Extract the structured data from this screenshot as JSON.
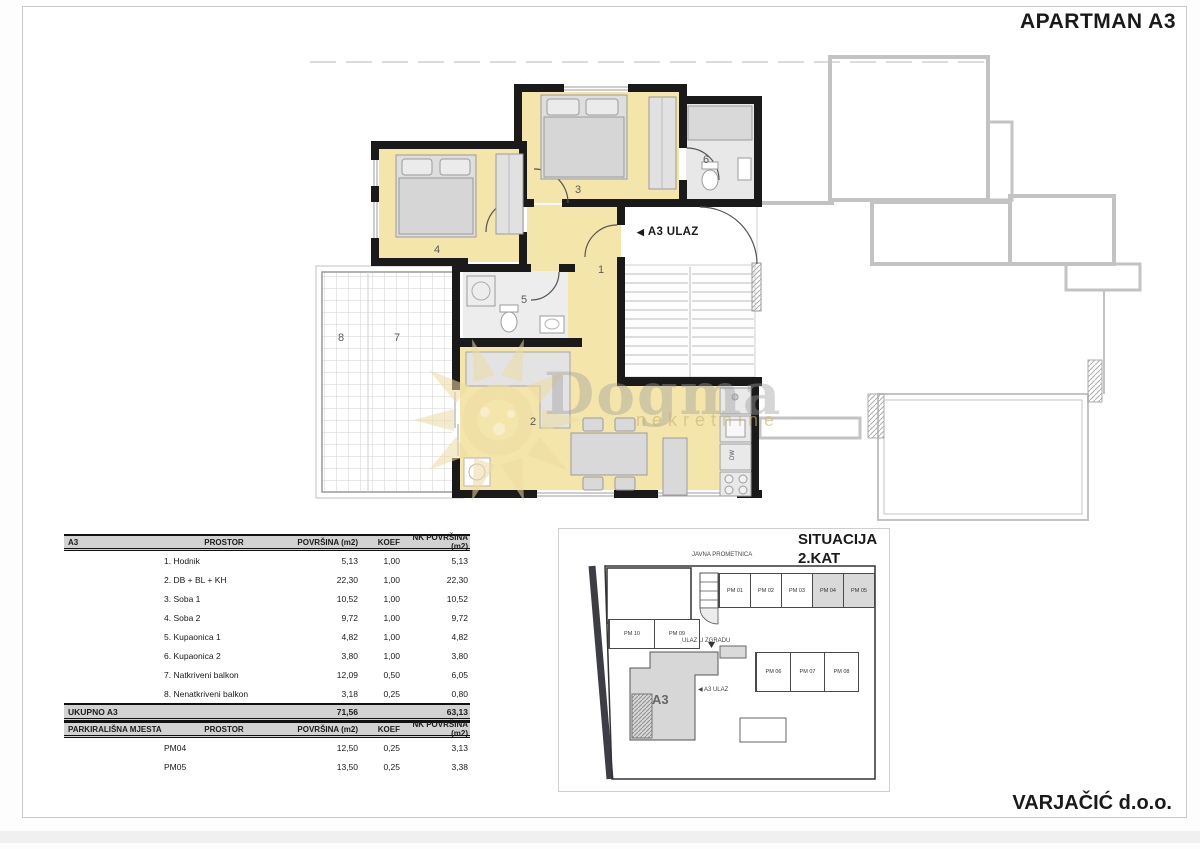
{
  "page": {
    "title": "APARTMAN A3",
    "company": "VARJAČIĆ d.o.o."
  },
  "floorplan": {
    "entrance_arrow": "◀",
    "entrance_label": "A3 ULAZ",
    "dishwasher_label": "DW",
    "room_numbers": {
      "hall": "1",
      "living": "2",
      "bedroom1": "3",
      "bedroom2": "4",
      "bathroom1": "5",
      "bathroom2": "6",
      "covered_balcony": "7",
      "uncovered_balcony": "8"
    },
    "watermark": {
      "brand": "Dogma",
      "subtitle": "nekretnine"
    }
  },
  "area_table": {
    "headers": {
      "group": "A3",
      "space": "PROSTOR",
      "area": "POVRŠINA (m2)",
      "koef": "KOEF",
      "nk_area": "NK POVRŠINA (m2)"
    },
    "rows": [
      {
        "name": "1. Hodnik",
        "area": "5,13",
        "koef": "1,00",
        "nk": "5,13"
      },
      {
        "name": "2. DB + BL + KH",
        "area": "22,30",
        "koef": "1,00",
        "nk": "22,30"
      },
      {
        "name": "3. Soba 1",
        "area": "10,52",
        "koef": "1,00",
        "nk": "10,52"
      },
      {
        "name": "4. Soba 2",
        "area": "9,72",
        "koef": "1,00",
        "nk": "9,72"
      },
      {
        "name": "5. Kupaonica 1",
        "area": "4,82",
        "koef": "1,00",
        "nk": "4,82"
      },
      {
        "name": "6. Kupaonica 2",
        "area": "3,80",
        "koef": "1,00",
        "nk": "3,80"
      },
      {
        "name": "7. Natkriveni balkon",
        "area": "12,09",
        "koef": "0,50",
        "nk": "6,05"
      },
      {
        "name": "8. Nenatkriveni balkon",
        "area": "3,18",
        "koef": "0,25",
        "nk": "0,80"
      }
    ],
    "total": {
      "label": "UKUPNO A3",
      "area": "71,56",
      "nk": "63,13"
    },
    "parking_headers": {
      "group": "PARKIRALIŠNA MJESTA",
      "space": "PROSTOR",
      "area": "POVRŠINA (m2)",
      "koef": "KOEF",
      "nk_area": "NK POVRŠINA (m2)"
    },
    "parking_rows": [
      {
        "name": "PM04",
        "area": "12,50",
        "koef": "0,25",
        "nk": "3,13"
      },
      {
        "name": "PM05",
        "area": "13,50",
        "koef": "0,25",
        "nk": "3,38"
      }
    ]
  },
  "situation": {
    "title_line1": "SITUACIJA",
    "title_line2": "2.KAT",
    "street_label": "JAVNA PROMETNICA",
    "building_entrance_label": "ULAZ U ZGRADU",
    "apartment_label": "A3",
    "apartment_entrance_label": "◀ A3 ULAZ",
    "parking_top": [
      {
        "label": "PM 01"
      },
      {
        "label": "PM 02"
      },
      {
        "label": "PM 03"
      },
      {
        "label": "PM 04",
        "shaded": true
      },
      {
        "label": "PM 05",
        "shaded": true
      }
    ],
    "parking_left": [
      {
        "label": "PM 10"
      },
      {
        "label": "PM 09"
      }
    ],
    "parking_mid": [
      {
        "label": "PM 06"
      },
      {
        "label": "PM 07"
      },
      {
        "label": "PM 08"
      }
    ]
  }
}
